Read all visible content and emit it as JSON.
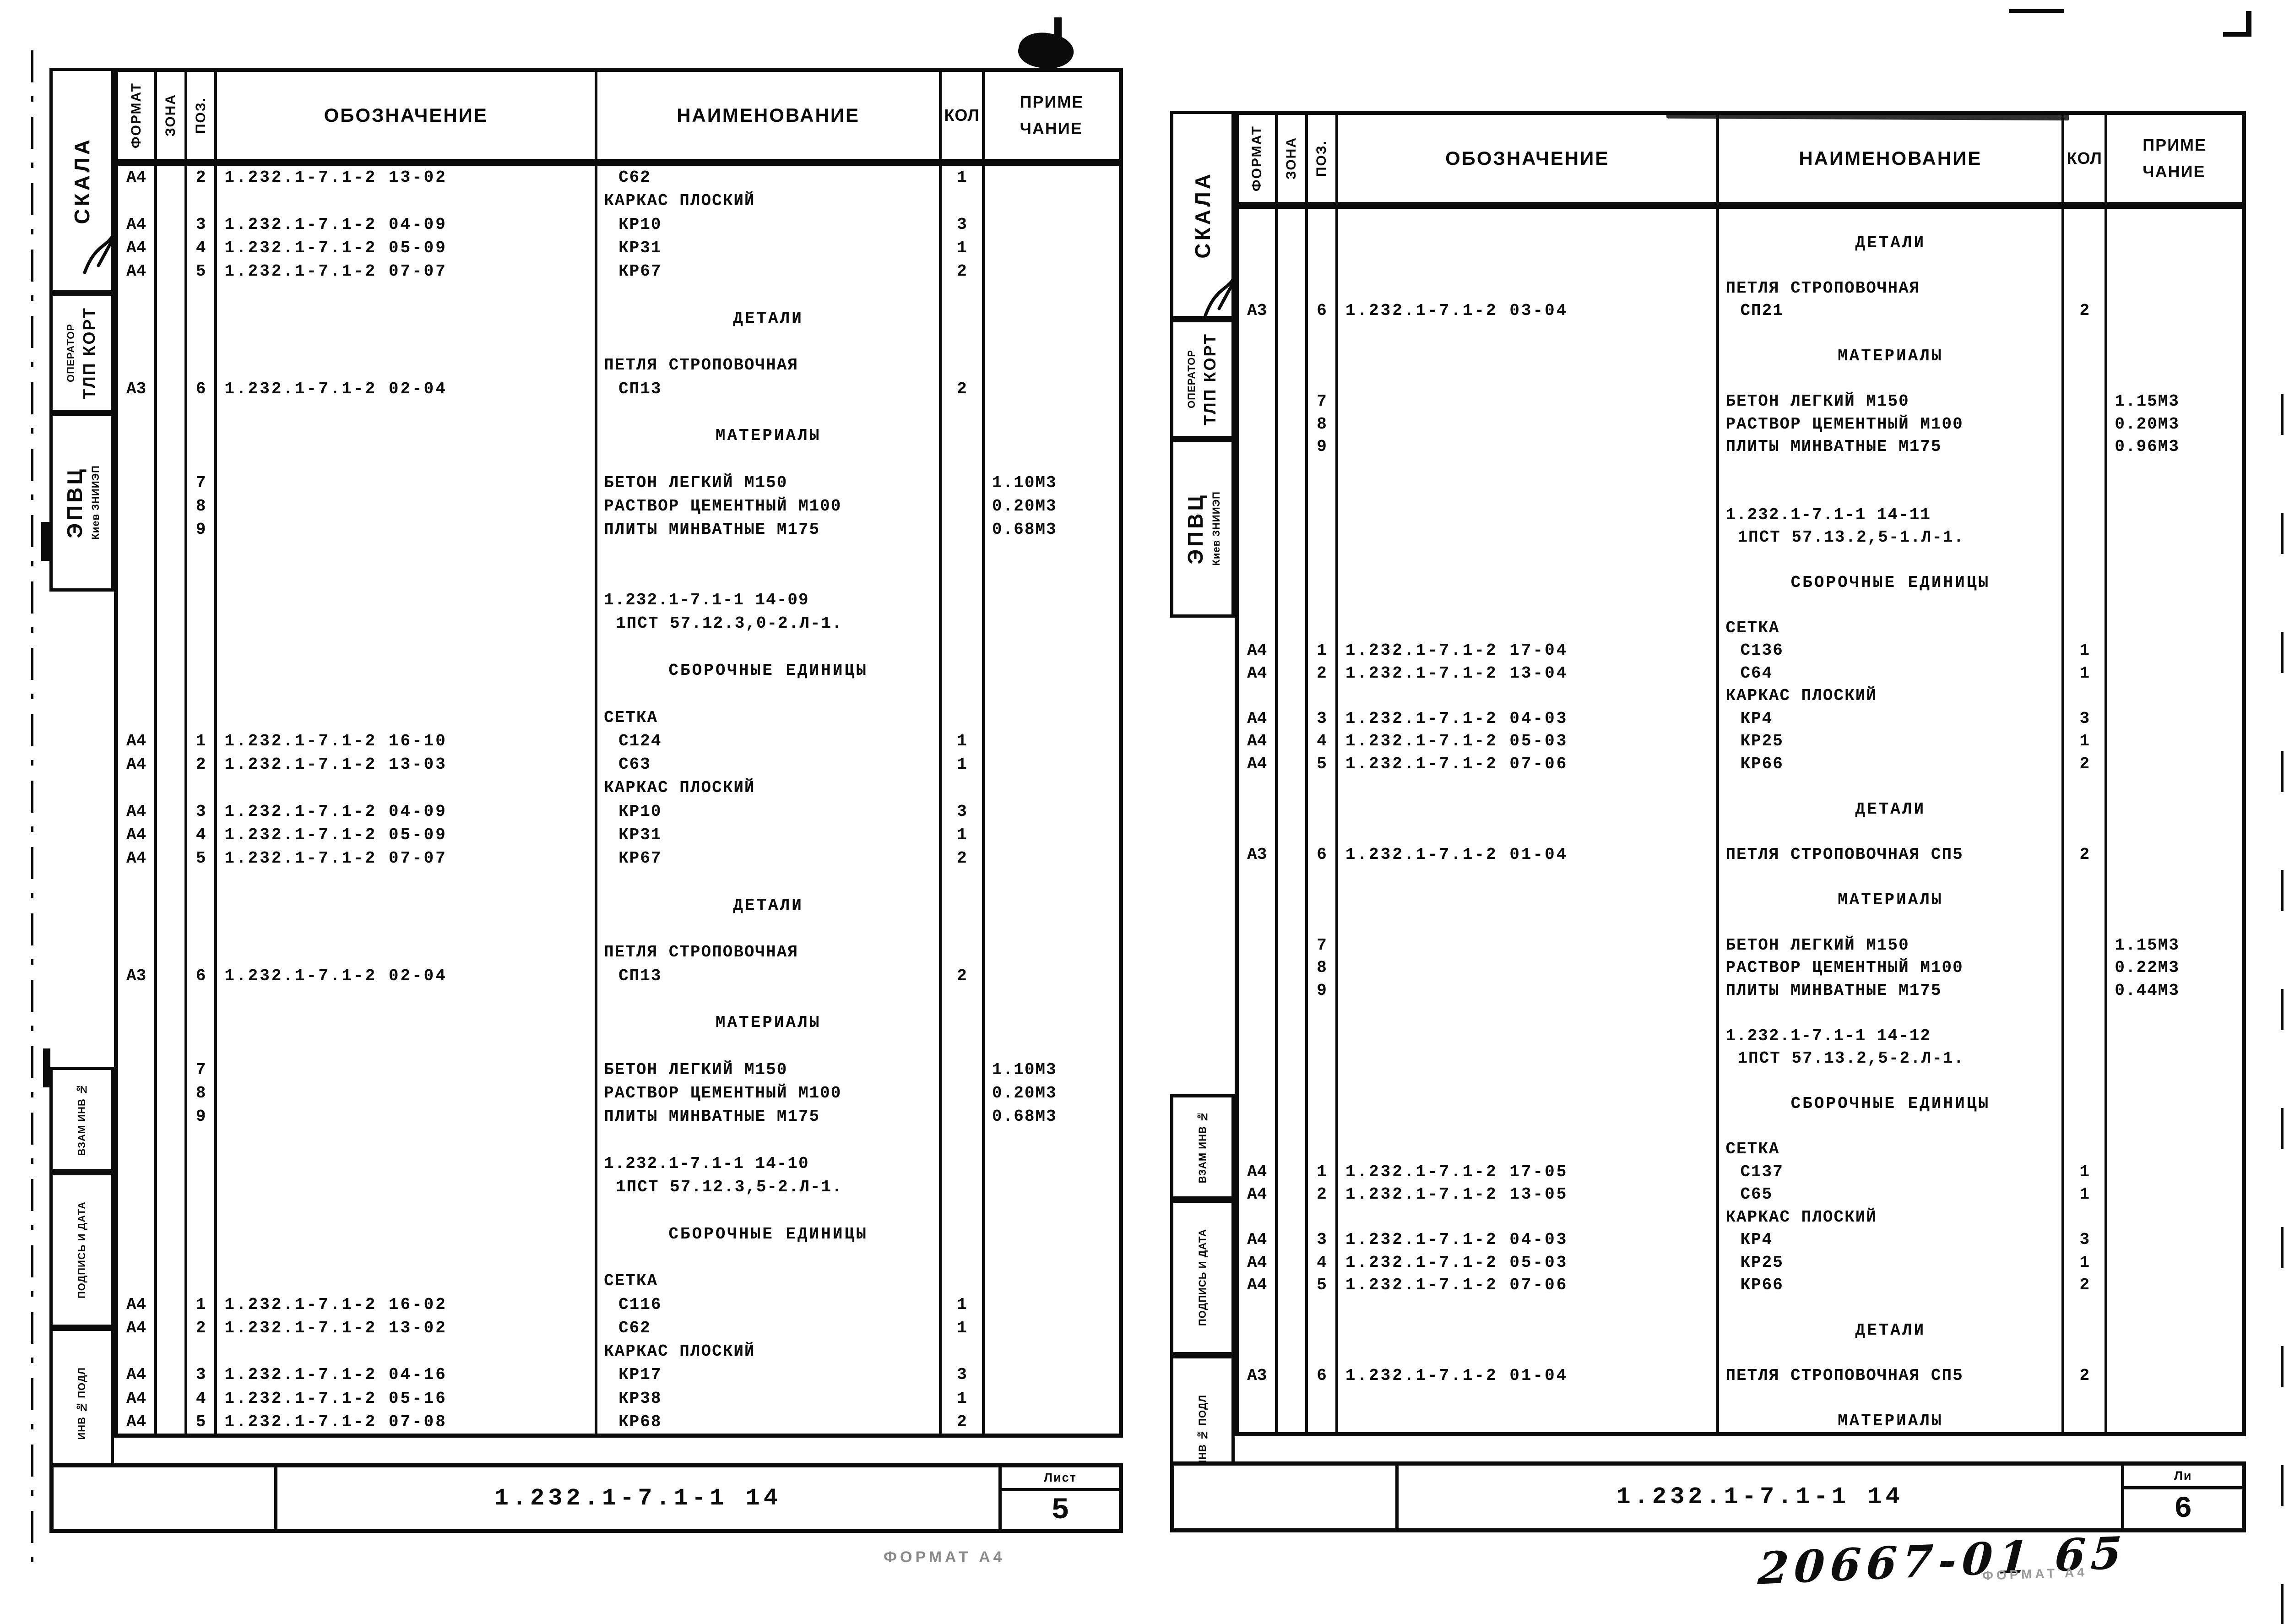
{
  "document_type": "Спецификация (ГОСТ) — сканированный лист",
  "ink_color": "#0b0b0b",
  "paper_color": "#ffffff",
  "artifacts": {
    "handwritten_note": "20667-01  65",
    "format_note_left": "ФОРМАТ А4",
    "format_note_right": "ФОРМАТ А4"
  },
  "sheets": [
    {
      "page": "left",
      "header": {
        "format": "ФОРМАТ",
        "zone": "ЗОНА",
        "pos": "ПОЗ.",
        "designation": "ОБОЗНАЧЕНИЕ",
        "name": "НАИМЕНОВАНИЕ",
        "qty": "КОЛ",
        "note1": "ПРИМЕ",
        "note2": "ЧАНИЕ"
      },
      "sidebar": {
        "stamp": "СКАЛА",
        "operator_small": "ОПЕРАТОР",
        "operator_big": "ТЛП КОРТ",
        "org_big": "ЭПВЦ",
        "org_small": "Киев ЗНИИЭП",
        "vzam": "ВЗАМ ИНВ №",
        "podpis": "ПОДПИСЬ И ДАТА",
        "inv": "ИНВ № ПОДЛ"
      },
      "footer": {
        "doc": "1.232.1-7.1-1 14",
        "sheet_label": "Лист",
        "sheet_number": "5"
      },
      "rows": [
        {
          "st": "item",
          "f": "А4",
          "p": "2",
          "d": "1.232.1-7.1-2 13-02",
          "n": "С62",
          "q": "1",
          "t": ""
        },
        {
          "st": "group",
          "n": "КАРКАС ПЛОСКИЙ"
        },
        {
          "st": "item",
          "f": "А4",
          "p": "3",
          "d": "1.232.1-7.1-2 04-09",
          "n": "КР10",
          "q": "3",
          "t": ""
        },
        {
          "st": "item",
          "f": "А4",
          "p": "4",
          "d": "1.232.1-7.1-2 05-09",
          "n": "КР31",
          "q": "1",
          "t": ""
        },
        {
          "st": "item",
          "f": "А4",
          "p": "5",
          "d": "1.232.1-7.1-2 07-07",
          "n": "КР67",
          "q": "2",
          "t": ""
        },
        {
          "st": "blank"
        },
        {
          "st": "section",
          "n": "ДЕТАЛИ"
        },
        {
          "st": "blank"
        },
        {
          "st": "group",
          "n": "ПЕТЛЯ СТРОПОВОЧНАЯ"
        },
        {
          "st": "item",
          "f": "А3",
          "p": "6",
          "d": "1.232.1-7.1-2 02-04",
          "n": "СП13",
          "q": "2",
          "t": ""
        },
        {
          "st": "blank"
        },
        {
          "st": "section",
          "n": "МАТЕРИАЛЫ"
        },
        {
          "st": "blank"
        },
        {
          "st": "group",
          "p": "7",
          "n": "БЕТОН ЛЕГКИЙ М150",
          "t": "1.10М3"
        },
        {
          "st": "group",
          "p": "8",
          "n": "РАСТВОР ЦЕМЕНТНЫЙ М100",
          "t": "0.20М3"
        },
        {
          "st": "group",
          "p": "9",
          "n": "ПЛИТЫ МИНВАТНЫЕ М175",
          "t": "0.68М3"
        },
        {
          "st": "blank"
        },
        {
          "st": "blank"
        },
        {
          "st": "ref",
          "n": "1.232.1-7.1-1 14-09"
        },
        {
          "st": "ref2",
          "n": "1ПСТ 57.12.3,0-2.Л-1."
        },
        {
          "st": "blank"
        },
        {
          "st": "section",
          "n": "СБОРОЧНЫЕ ЕДИНИЦЫ"
        },
        {
          "st": "blank"
        },
        {
          "st": "group",
          "n": "СЕТКА"
        },
        {
          "st": "item",
          "f": "А4",
          "p": "1",
          "d": "1.232.1-7.1-2 16-10",
          "n": "С124",
          "q": "1",
          "t": ""
        },
        {
          "st": "item",
          "f": "А4",
          "p": "2",
          "d": "1.232.1-7.1-2 13-03",
          "n": "С63",
          "q": "1",
          "t": ""
        },
        {
          "st": "group",
          "n": "КАРКАС ПЛОСКИЙ"
        },
        {
          "st": "item",
          "f": "А4",
          "p": "3",
          "d": "1.232.1-7.1-2 04-09",
          "n": "КР10",
          "q": "3",
          "t": ""
        },
        {
          "st": "item",
          "f": "А4",
          "p": "4",
          "d": "1.232.1-7.1-2 05-09",
          "n": "КР31",
          "q": "1",
          "t": ""
        },
        {
          "st": "item",
          "f": "А4",
          "p": "5",
          "d": "1.232.1-7.1-2 07-07",
          "n": "КР67",
          "q": "2",
          "t": ""
        },
        {
          "st": "blank"
        },
        {
          "st": "section",
          "n": "ДЕТАЛИ"
        },
        {
          "st": "blank"
        },
        {
          "st": "group",
          "n": "ПЕТЛЯ СТРОПОВОЧНАЯ"
        },
        {
          "st": "item",
          "f": "А3",
          "p": "6",
          "d": "1.232.1-7.1-2 02-04",
          "n": "СП13",
          "q": "2",
          "t": ""
        },
        {
          "st": "blank"
        },
        {
          "st": "section",
          "n": "МАТЕРИАЛЫ"
        },
        {
          "st": "blank"
        },
        {
          "st": "group",
          "p": "7",
          "n": "БЕТОН ЛЕГКИЙ М150",
          "t": "1.10М3"
        },
        {
          "st": "group",
          "p": "8",
          "n": "РАСТВОР ЦЕМЕНТНЫЙ М100",
          "t": "0.20М3"
        },
        {
          "st": "group",
          "p": "9",
          "n": "ПЛИТЫ МИНВАТНЫЕ М175",
          "t": "0.68М3"
        },
        {
          "st": "blank"
        },
        {
          "st": "ref",
          "n": "1.232.1-7.1-1 14-10"
        },
        {
          "st": "ref2",
          "n": "1ПСТ 57.12.3,5-2.Л-1."
        },
        {
          "st": "blank"
        },
        {
          "st": "section",
          "n": "СБОРОЧНЫЕ ЕДИНИЦЫ"
        },
        {
          "st": "blank"
        },
        {
          "st": "group",
          "n": "СЕТКА"
        },
        {
          "st": "item",
          "f": "А4",
          "p": "1",
          "d": "1.232.1-7.1-2 16-02",
          "n": "С116",
          "q": "1",
          "t": ""
        },
        {
          "st": "item",
          "f": "А4",
          "p": "2",
          "d": "1.232.1-7.1-2 13-02",
          "n": "С62",
          "q": "1",
          "t": ""
        },
        {
          "st": "group",
          "n": "КАРКАС ПЛОСКИЙ"
        },
        {
          "st": "item",
          "f": "А4",
          "p": "3",
          "d": "1.232.1-7.1-2 04-16",
          "n": "КР17",
          "q": "3",
          "t": ""
        },
        {
          "st": "item",
          "f": "А4",
          "p": "4",
          "d": "1.232.1-7.1-2 05-16",
          "n": "КР38",
          "q": "1",
          "t": ""
        },
        {
          "st": "item",
          "f": "А4",
          "p": "5",
          "d": "1.232.1-7.1-2 07-08",
          "n": "КР68",
          "q": "2",
          "t": ""
        }
      ]
    },
    {
      "page": "right",
      "header": {
        "format": "ФОРМАТ",
        "zone": "ЗОНА",
        "pos": "ПОЗ.",
        "designation": "ОБОЗНАЧЕНИЕ",
        "name": "НАИМЕНОВАНИЕ",
        "qty": "КОЛ",
        "note1": "ПРИМЕ",
        "note2": "ЧАНИЕ"
      },
      "sidebar": {
        "stamp": "СКАЛА",
        "operator_small": "ОПЕРАТОР",
        "operator_big": "ТЛП КОРТ",
        "org_big": "ЭПВЦ",
        "org_small": "Киев ЗНИИЭП",
        "vzam": "ВЗАМ ИНВ №",
        "podpis": "ПОДПИСЬ И ДАТА",
        "inv": "ИНВ № ПОДЛ"
      },
      "footer": {
        "doc": "1.232.1-7.1-1 14",
        "sheet_label": "Ли",
        "sheet_number": "6"
      },
      "rows": [
        {
          "st": "blank"
        },
        {
          "st": "section",
          "n": "ДЕТАЛИ"
        },
        {
          "st": "blank"
        },
        {
          "st": "group",
          "n": "ПЕТЛЯ СТРОПОВОЧНАЯ"
        },
        {
          "st": "item",
          "f": "А3",
          "p": "6",
          "d": "1.232.1-7.1-2 03-04",
          "n": "СП21",
          "q": "2",
          "t": ""
        },
        {
          "st": "blank"
        },
        {
          "st": "section",
          "n": "МАТЕРИАЛЫ"
        },
        {
          "st": "blank"
        },
        {
          "st": "group",
          "p": "7",
          "n": "БЕТОН ЛЕГКИЙ М150",
          "t": "1.15М3"
        },
        {
          "st": "group",
          "p": "8",
          "n": "РАСТВОР ЦЕМЕНТНЫЙ М100",
          "t": "0.20М3"
        },
        {
          "st": "group",
          "p": "9",
          "n": "ПЛИТЫ МИНВАТНЫЕ М175",
          "t": "0.96М3"
        },
        {
          "st": "blank"
        },
        {
          "st": "blank"
        },
        {
          "st": "ref",
          "n": "1.232.1-7.1-1 14-11"
        },
        {
          "st": "ref2",
          "n": "1ПСТ 57.13.2,5-1.Л-1."
        },
        {
          "st": "blank"
        },
        {
          "st": "section",
          "n": "СБОРОЧНЫЕ ЕДИНИЦЫ"
        },
        {
          "st": "blank"
        },
        {
          "st": "group",
          "n": "СЕТКА"
        },
        {
          "st": "item",
          "f": "А4",
          "p": "1",
          "d": "1.232.1-7.1-2 17-04",
          "n": "С136",
          "q": "1",
          "t": ""
        },
        {
          "st": "item",
          "f": "А4",
          "p": "2",
          "d": "1.232.1-7.1-2 13-04",
          "n": "С64",
          "q": "1",
          "t": ""
        },
        {
          "st": "group",
          "n": "КАРКАС ПЛОСКИЙ"
        },
        {
          "st": "item",
          "f": "А4",
          "p": "3",
          "d": "1.232.1-7.1-2 04-03",
          "n": "КР4",
          "q": "3",
          "t": ""
        },
        {
          "st": "item",
          "f": "А4",
          "p": "4",
          "d": "1.232.1-7.1-2 05-03",
          "n": "КР25",
          "q": "1",
          "t": ""
        },
        {
          "st": "item",
          "f": "А4",
          "p": "5",
          "d": "1.232.1-7.1-2 07-06",
          "n": "КР66",
          "q": "2",
          "t": ""
        },
        {
          "st": "blank"
        },
        {
          "st": "section",
          "n": "ДЕТАЛИ"
        },
        {
          "st": "blank"
        },
        {
          "st": "group",
          "f": "А3",
          "p": "6",
          "d": "1.232.1-7.1-2 01-04",
          "n": "ПЕТЛЯ СТРОПОВОЧНАЯ СП5",
          "q": "2",
          "t": ""
        },
        {
          "st": "blank"
        },
        {
          "st": "section",
          "n": "МАТЕРИАЛЫ"
        },
        {
          "st": "blank"
        },
        {
          "st": "group",
          "p": "7",
          "n": "БЕТОН ЛЕГКИЙ М150",
          "t": "1.15М3"
        },
        {
          "st": "group",
          "p": "8",
          "n": "РАСТВОР ЦЕМЕНТНЫЙ М100",
          "t": "0.22М3"
        },
        {
          "st": "group",
          "p": "9",
          "n": "ПЛИТЫ МИНВАТНЫЕ М175",
          "t": "0.44М3"
        },
        {
          "st": "blank"
        },
        {
          "st": "ref",
          "n": "1.232.1-7.1-1 14-12"
        },
        {
          "st": "ref2",
          "n": "1ПСТ 57.13.2,5-2.Л-1."
        },
        {
          "st": "blank"
        },
        {
          "st": "section",
          "n": "СБОРОЧНЫЕ ЕДИНИЦЫ"
        },
        {
          "st": "blank"
        },
        {
          "st": "group",
          "n": "СЕТКА"
        },
        {
          "st": "item",
          "f": "А4",
          "p": "1",
          "d": "1.232.1-7.1-2 17-05",
          "n": "С137",
          "q": "1",
          "t": ""
        },
        {
          "st": "item",
          "f": "А4",
          "p": "2",
          "d": "1.232.1-7.1-2 13-05",
          "n": "С65",
          "q": "1",
          "t": ""
        },
        {
          "st": "group",
          "n": "КАРКАС ПЛОСКИЙ"
        },
        {
          "st": "item",
          "f": "А4",
          "p": "3",
          "d": "1.232.1-7.1-2 04-03",
          "n": "КР4",
          "q": "3",
          "t": ""
        },
        {
          "st": "item",
          "f": "А4",
          "p": "4",
          "d": "1.232.1-7.1-2 05-03",
          "n": "КР25",
          "q": "1",
          "t": ""
        },
        {
          "st": "item",
          "f": "А4",
          "p": "5",
          "d": "1.232.1-7.1-2 07-06",
          "n": "КР66",
          "q": "2",
          "t": ""
        },
        {
          "st": "blank"
        },
        {
          "st": "section",
          "n": "ДЕТАЛИ"
        },
        {
          "st": "blank"
        },
        {
          "st": "group",
          "f": "А3",
          "p": "6",
          "d": "1.232.1-7.1-2 01-04",
          "n": "ПЕТЛЯ СТРОПОВОЧНАЯ СП5",
          "q": "2",
          "t": ""
        },
        {
          "st": "blank"
        },
        {
          "st": "section",
          "n": "МАТЕРИАЛЫ"
        }
      ]
    }
  ]
}
